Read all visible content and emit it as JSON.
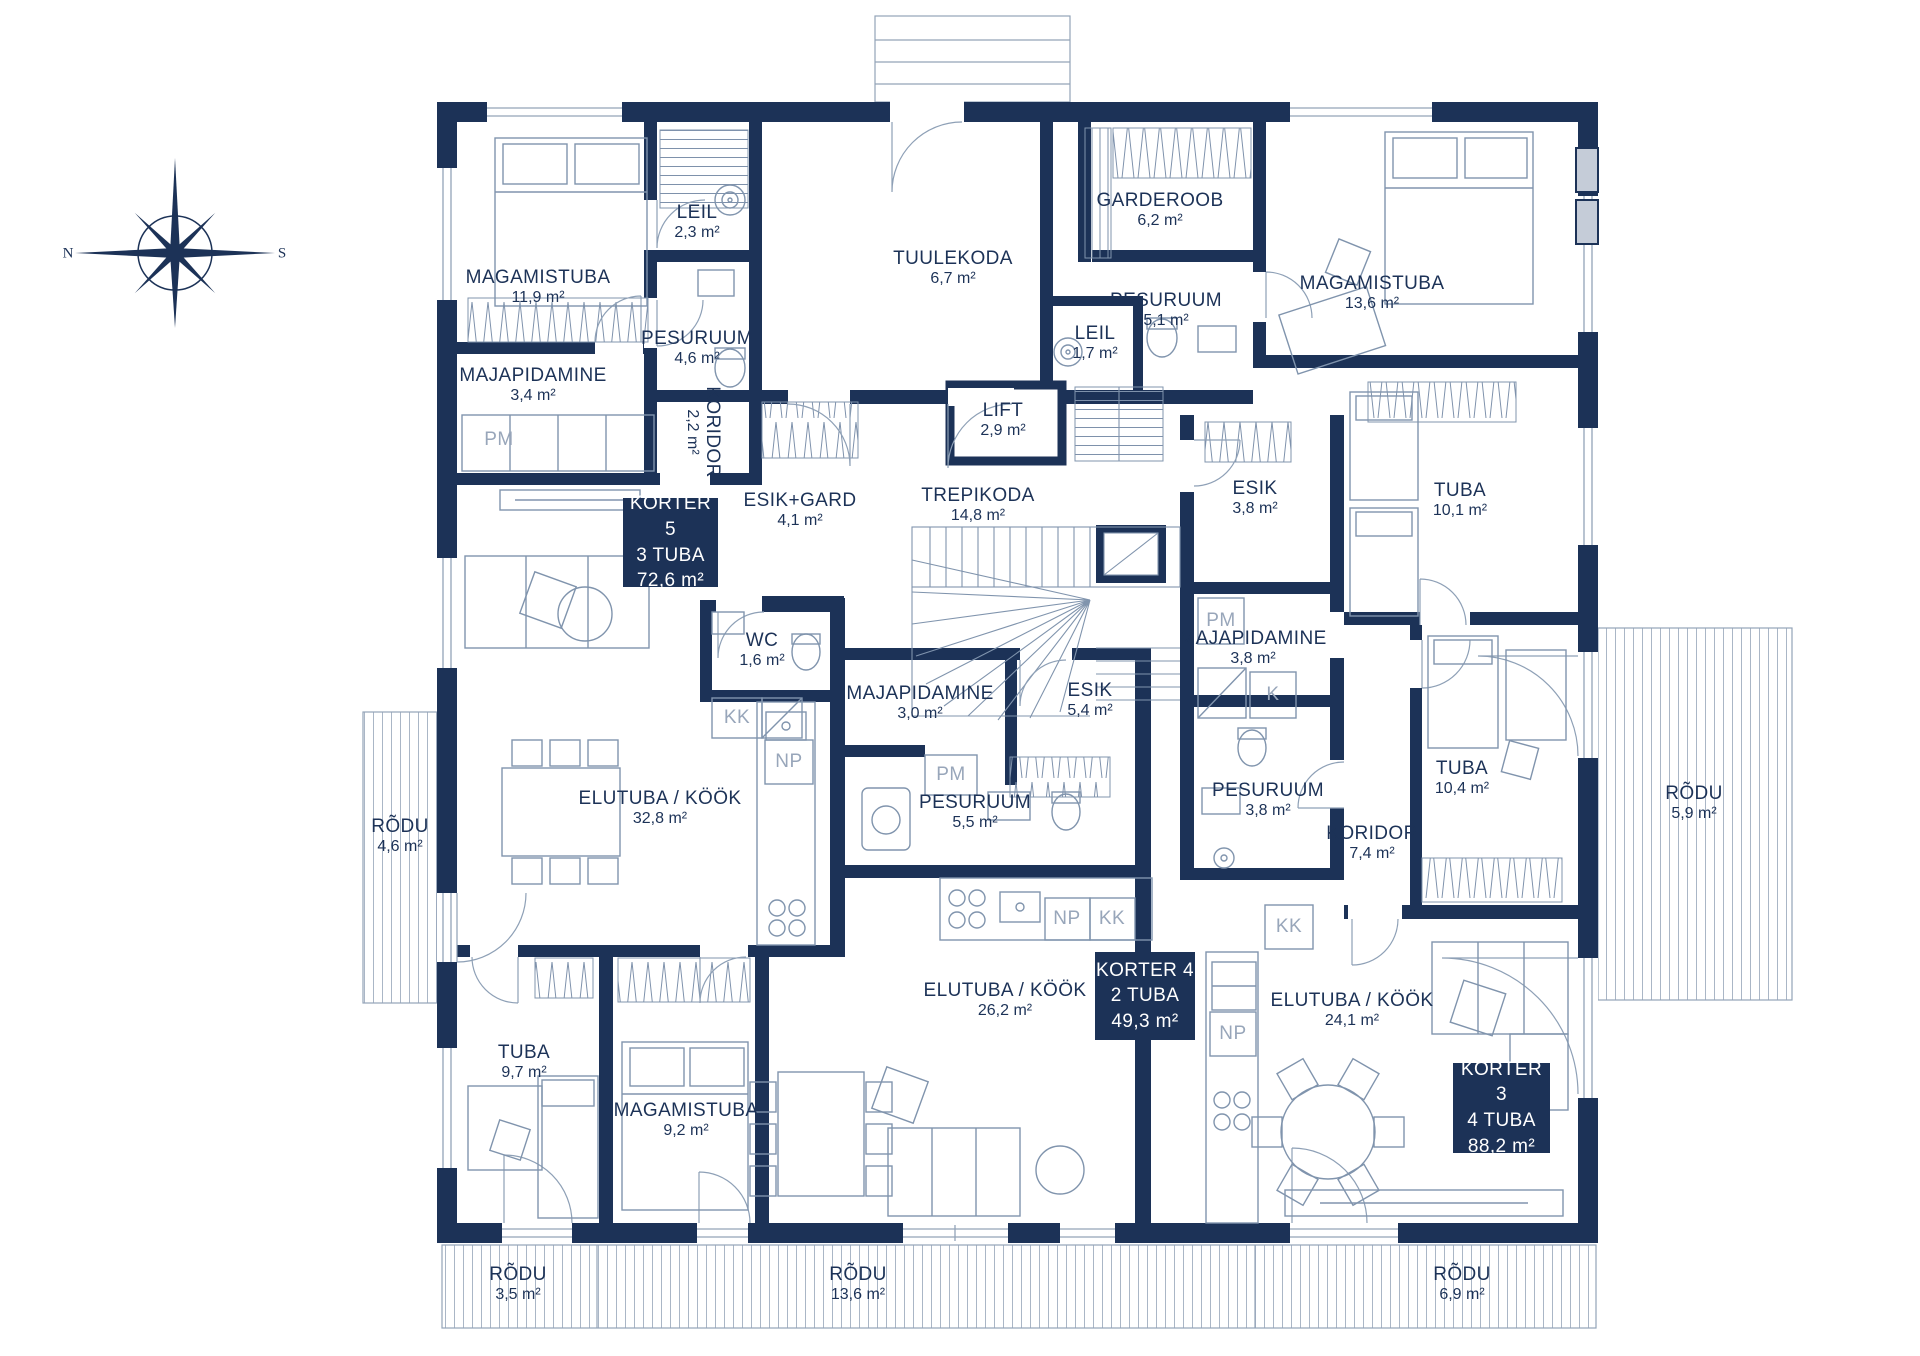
{
  "compass": {
    "north": "N",
    "south": "S"
  },
  "apartments": [
    {
      "name": "KORTER 5",
      "rooms": "3 TUBA",
      "area": "72,6 m²"
    },
    {
      "name": "KORTER 4",
      "rooms": "2 TUBA",
      "area": "49,3 m²"
    },
    {
      "name": "KORTER 3",
      "rooms": "4 TUBA",
      "area": "88,2 m²"
    }
  ],
  "rooms": [
    {
      "name": "MAGAMISTUBA",
      "area": "11,9 m²"
    },
    {
      "name": "LEIL",
      "area": "2,3 m²"
    },
    {
      "name": "TUULEKODA",
      "area": "6,7 m²"
    },
    {
      "name": "GARDEROOB",
      "area": "6,2 m²"
    },
    {
      "name": "MAGAMISTUBA",
      "area": "13,6 m²"
    },
    {
      "name": "PESURUUM",
      "area": "5,1 m²"
    },
    {
      "name": "LEIL",
      "area": "1,7 m²"
    },
    {
      "name": "LIFT",
      "area": "2,9 m²"
    },
    {
      "name": "MAJAPIDAMINE",
      "area": "3,4 m²"
    },
    {
      "name": "PESURUUM",
      "area": "4,6 m²"
    },
    {
      "name": "KORIDOR",
      "area": "2,2 m²"
    },
    {
      "name": "ESIK+GARD",
      "area": "4,1 m²"
    },
    {
      "name": "TREPIKODA",
      "area": "14,8 m²"
    },
    {
      "name": "ESIK",
      "area": "3,8 m²"
    },
    {
      "name": "TUBA",
      "area": "10,1 m²"
    },
    {
      "name": "WC",
      "area": "1,6 m²"
    },
    {
      "name": "MAJAPIDAMINE",
      "area": "3,0 m²"
    },
    {
      "name": "ESIK",
      "area": "5,4 m²"
    },
    {
      "name": "MAJAPIDAMINE",
      "area": "3,8 m²"
    },
    {
      "name": "PESURUUM",
      "area": "5,5 m²"
    },
    {
      "name": "PESURUUM",
      "area": "3,8 m²"
    },
    {
      "name": "KORIDOR",
      "area": "7,4 m²"
    },
    {
      "name": "TUBA",
      "area": "10,4 m²"
    },
    {
      "name": "ELUTUBA / KÖÖK",
      "area": "32,8 m²"
    },
    {
      "name": "RÕDU",
      "area": "4,6 m²"
    },
    {
      "name": "RÕDU",
      "area": "5,9 m²"
    },
    {
      "name": "ELUTUBA / KÖÖK",
      "area": "26,2 m²"
    },
    {
      "name": "ELUTUBA / KÖÖK",
      "area": "24,1 m²"
    },
    {
      "name": "TUBA",
      "area": "9,7 m²"
    },
    {
      "name": "MAGAMISTUBA",
      "area": "9,2 m²"
    },
    {
      "name": "RÕDU",
      "area": "3,5 m²"
    },
    {
      "name": "RÕDU",
      "area": "13,6 m²"
    },
    {
      "name": "RÕDU",
      "area": "6,9 m²"
    }
  ],
  "cabinets": [
    {
      "label": "PM"
    },
    {
      "label": "KK"
    },
    {
      "label": "NP"
    },
    {
      "label": "PM"
    },
    {
      "label": "NP"
    },
    {
      "label": "KK"
    },
    {
      "label": "PM"
    },
    {
      "label": "K"
    },
    {
      "label": "KK"
    },
    {
      "label": "NP"
    }
  ],
  "colors": {
    "wall": "#1c3257",
    "line": "#8094ad",
    "muted_label": "#98a6ba",
    "glazing": "#c5ccd8"
  }
}
